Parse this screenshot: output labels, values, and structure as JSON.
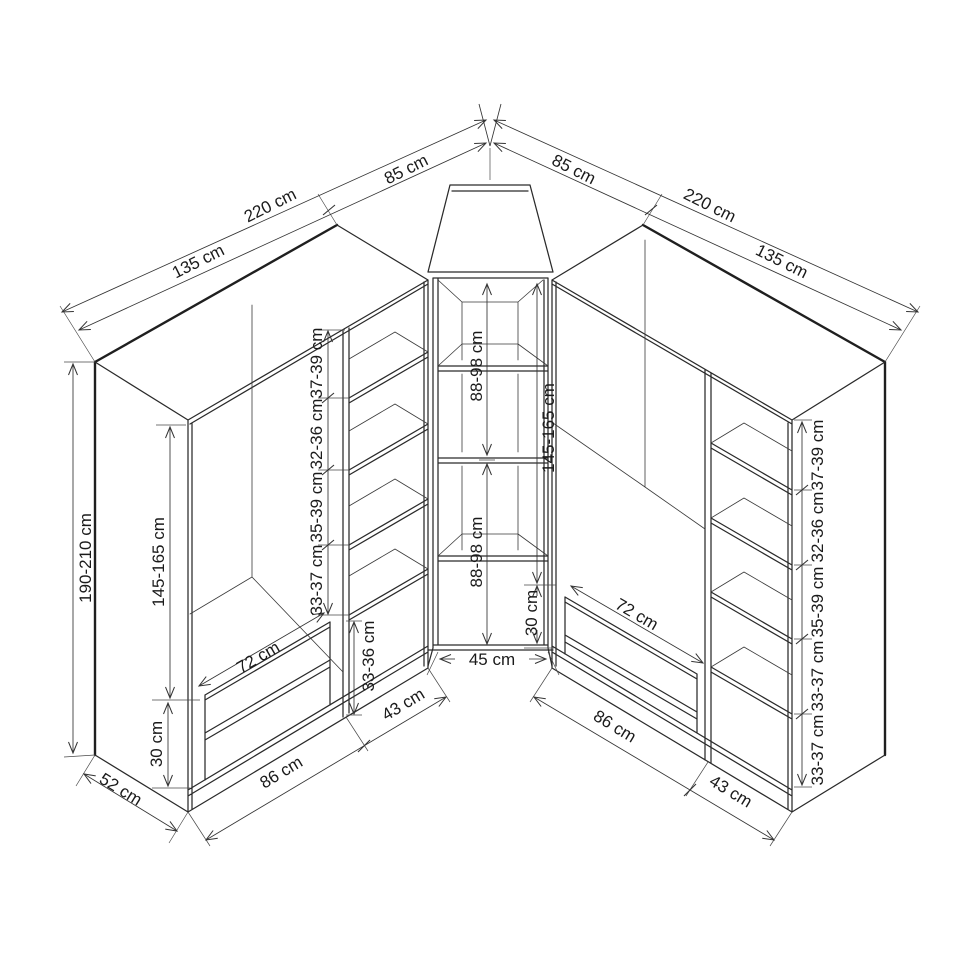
{
  "drawing": {
    "subject": "Corner wardrobe assembly diagram",
    "unit": "cm"
  },
  "dimensions": {
    "top_left": {
      "unit_width": "135 cm",
      "wall_total": "220 cm",
      "corner_width": "85 cm"
    },
    "top_right": {
      "unit_width": "135 cm",
      "wall_total": "220 cm",
      "corner_width": "85 cm"
    },
    "left_unit": {
      "height": "190-210 cm",
      "depth": "52 cm",
      "hanging_height": "145-165 cm",
      "drawer_section_height": "30 cm",
      "drawer_width": "72 cm",
      "front_width": "86 cm",
      "shelf_column_width": "43 cm",
      "bottom_shelf_gap": "33-36 cm",
      "shelf_gaps_bottom_to_top": [
        "33-37 cm",
        "35-39 cm",
        "32-36 cm",
        "37-39 cm"
      ]
    },
    "corner_unit": {
      "upper_section": "88-98 cm",
      "lower_section": "88-98 cm",
      "hanging_height": "145-165 cm",
      "base_height": "30 cm",
      "inner_width": "45 cm"
    },
    "right_unit": {
      "drawer_width": "72 cm",
      "front_width": "86 cm",
      "shelf_column_width": "43 cm",
      "shelf_gaps_bottom_to_top": [
        "33-37 cm",
        "33-37 cm",
        "35-39 cm",
        "32-36 cm",
        "37-39 cm"
      ]
    }
  }
}
